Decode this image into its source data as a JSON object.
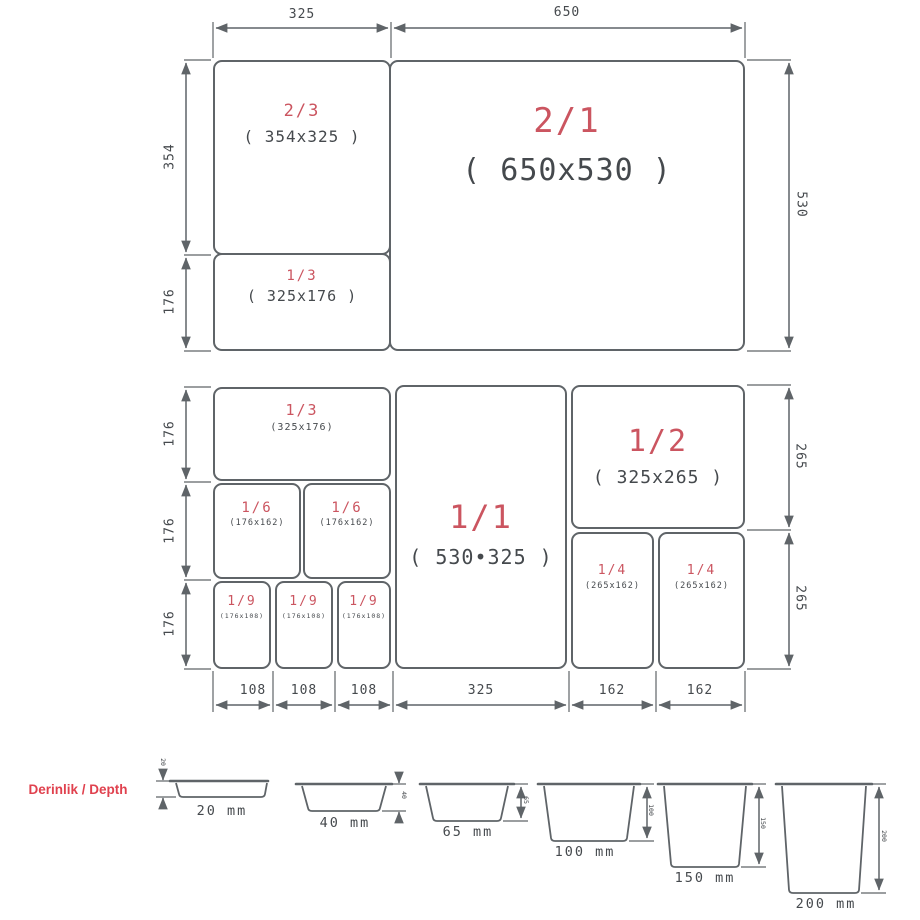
{
  "colors": {
    "accent_red": "#cb5560",
    "title_red": "#e0414e",
    "line_gray": "#5f6468",
    "dim_text": "#45494d"
  },
  "top_panel": {
    "boxes": [
      {
        "fraction": "2/3",
        "size": "( 354x325 )"
      },
      {
        "fraction": "1/3",
        "size": "( 325x176 )"
      },
      {
        "fraction": "2/1",
        "size": "( 650x530 )"
      }
    ],
    "dims": {
      "top": [
        "325",
        "650"
      ],
      "left": [
        "354",
        "176"
      ],
      "right": [
        "530"
      ]
    }
  },
  "middle_panel": {
    "boxes": [
      {
        "fraction": "1/3",
        "size": "(325x176)"
      },
      {
        "fraction": "1/6",
        "size": "(176x162)"
      },
      {
        "fraction": "1/6",
        "size": "(176x162)"
      },
      {
        "fraction": "1/9",
        "size": "(176x108)"
      },
      {
        "fraction": "1/9",
        "size": "(176x108)"
      },
      {
        "fraction": "1/9",
        "size": "(176x108)"
      },
      {
        "fraction": "1/1",
        "size": "( 530•325 )"
      },
      {
        "fraction": "1/2",
        "size": "( 325x265 )"
      },
      {
        "fraction": "1/4",
        "size": "(265x162)"
      },
      {
        "fraction": "1/4",
        "size": "(265x162)"
      }
    ],
    "dims": {
      "left": [
        "176",
        "176",
        "176"
      ],
      "right": [
        "265",
        "265"
      ],
      "bottom": [
        "108",
        "108",
        "108",
        "325",
        "162",
        "162"
      ]
    }
  },
  "depth_row": {
    "title": "Derinlik / Depth",
    "pans": [
      {
        "label": "20 mm",
        "tick": "20"
      },
      {
        "label": "40 mm",
        "tick": "40"
      },
      {
        "label": "65 mm",
        "tick": "65"
      },
      {
        "label": "100 mm",
        "tick": "100"
      },
      {
        "label": "150 mm",
        "tick": "150"
      },
      {
        "label": "200 mm",
        "tick": "200"
      }
    ]
  }
}
